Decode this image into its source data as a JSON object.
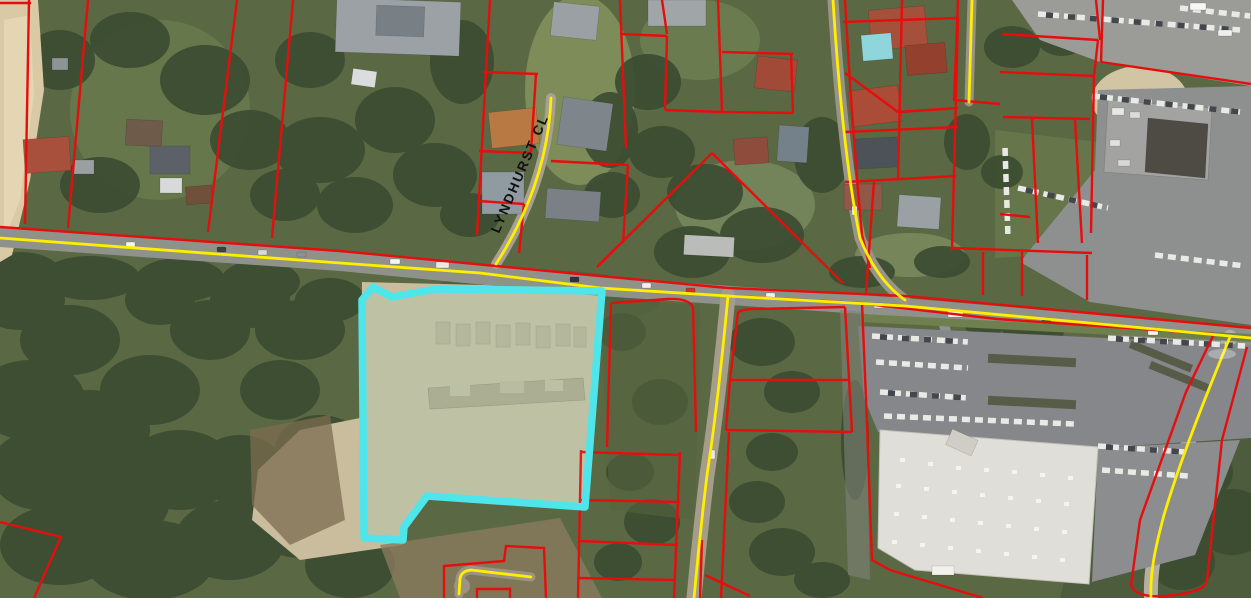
{
  "map": {
    "street_label": "LYNDHURST CL",
    "colors": {
      "parcel_boundary": "#e60d0d",
      "road_centerline": "#ffee00",
      "selected_parcel_outline": "#4ee6ea",
      "selected_parcel_tint": "rgba(110,235,240,0.10)"
    }
  }
}
